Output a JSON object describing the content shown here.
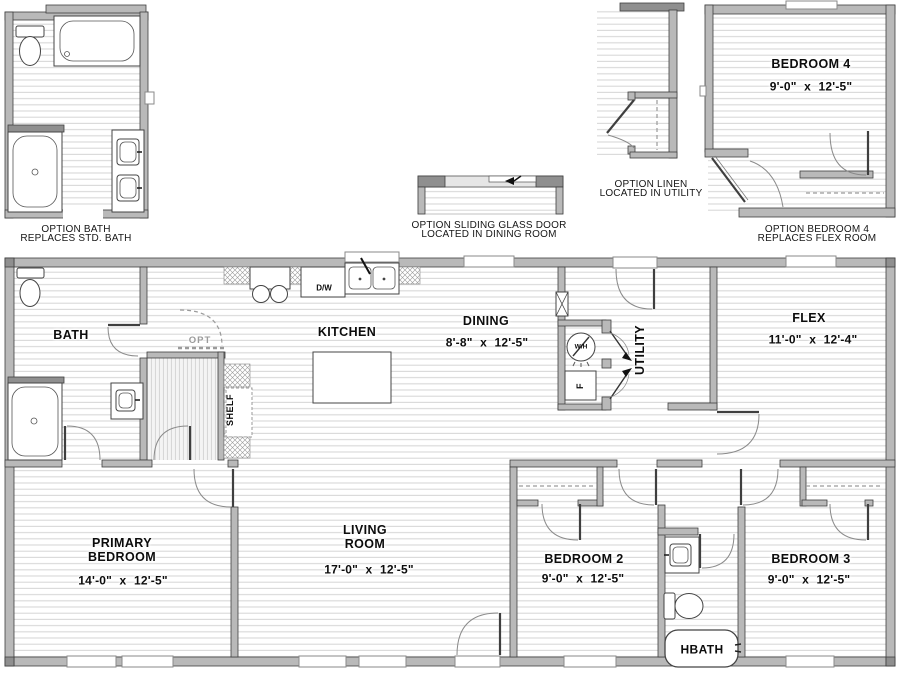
{
  "colors": {
    "wall_fill": "#b9b9b9",
    "wall_outline": "#3f3f3f",
    "floor_stripe": "#d8d8d8",
    "label_text": "#0c0c0c",
    "optional_gray": "#9a9a9a"
  },
  "options": {
    "bath_caption": {
      "line1": "OPTION BATH",
      "line2": "REPLACES STD. BATH"
    },
    "sliding_caption": {
      "line1": "OPTION SLIDING GLASS DOOR",
      "line2": "LOCATED IN DINING ROOM"
    },
    "linen_caption": {
      "line1": "OPTION LINEN",
      "line2": "LOCATED IN UTILITY"
    },
    "bedroom4_caption": {
      "line1": "OPTION BEDROOM 4",
      "line2": "REPLACES FLEX ROOM"
    },
    "bedroom4_room": {
      "name": "BEDROOM 4",
      "dims": "9'-0\" x 12'-5\""
    }
  },
  "rooms": {
    "bath": {
      "name": "BATH"
    },
    "kitchen": {
      "name": "KITCHEN"
    },
    "dining": {
      "name": "DINING",
      "dims": "8'-8\" x 12'-5\""
    },
    "utility": {
      "name": "UTILITY"
    },
    "flex": {
      "name": "FLEX",
      "dims": "11'-0\" x 12'-4\""
    },
    "primary": {
      "line1": "PRIMARY",
      "line2": "BEDROOM",
      "dims": "14'-0\" x 12'-5\""
    },
    "living": {
      "line1": "LIVING",
      "line2": "ROOM",
      "dims": "17'-0\" x 12'-5\""
    },
    "bedroom2": {
      "name": "BEDROOM 2",
      "dims": "9'-0\" x 12'-5\""
    },
    "bedroom3": {
      "name": "BEDROOM 3",
      "dims": "9'-0\" x 12'-5\""
    },
    "hbath": {
      "name": "HBATH"
    }
  },
  "annotations": {
    "opt_door": "OPT",
    "shelf": "SHELF",
    "dishwasher": "D/W",
    "water_heater": "W/H",
    "furnace": "F"
  }
}
